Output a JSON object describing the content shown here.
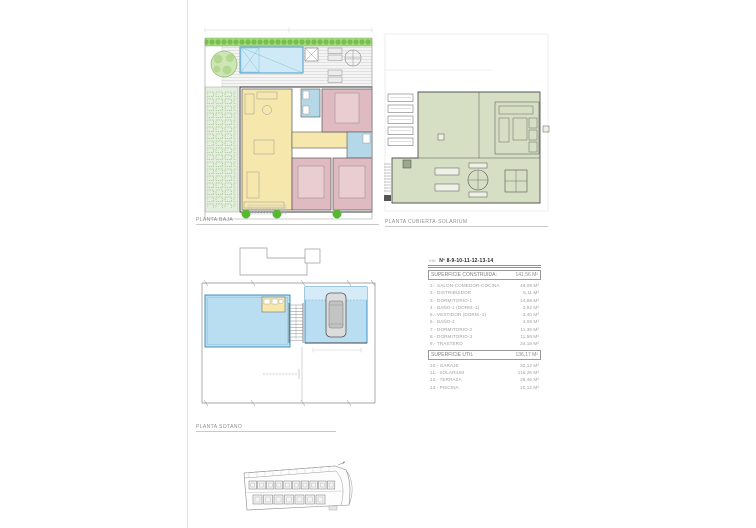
{
  "labels": {
    "planta_baja": "PLANTA BAJA",
    "planta_cubierta": "PLANTA CUBIERTA-SOLARIUM",
    "planta_sotano": "PLANTA SOTANO"
  },
  "table": {
    "viv_prefix": "VIV.",
    "title": "Nº 8-9-10-11-12-13-14",
    "construida": {
      "label": "SUPERFICIE CONSTRUIDA:",
      "value": "141,56 M²"
    },
    "rooms": [
      {
        "label": "1.- SALON-COMEDOR-COCINA",
        "value": "48,08 M²"
      },
      {
        "label": "2.- DISTRIBUIDOR",
        "value": "5,11 M²"
      },
      {
        "label": "3.- DORMITORIO-1",
        "value": "14,68 M²"
      },
      {
        "label": "4.- BAÑO-1 (DORM.-1)",
        "value": "3,92 M²"
      },
      {
        "label": "5.- VESTIDOR (DORM.-1)",
        "value": "3,40 M²"
      },
      {
        "label": "6.- BAÑO-2",
        "value": "4,09 M²"
      },
      {
        "label": "7.- DORMITORIO-2",
        "value": "11,36 M²"
      },
      {
        "label": "8.- DORMITORIO-3",
        "value": "11,56 M²"
      },
      {
        "label": "9.- TRASTERO",
        "value": "34,18 M²"
      }
    ],
    "util": {
      "label": "SUPERFICIE UTIL",
      "value": "136,17 M²"
    },
    "exterior": [
      {
        "label": "10.- GARAJE",
        "value": "32,12 M²"
      },
      {
        "label": "11.- SOLARIUM",
        "value": "116,26 M²"
      },
      {
        "label": "12.- TERRAZA",
        "value": "28,46 M²"
      },
      {
        "label": "13.- PISCINA",
        "value": "10,12 M²"
      }
    ]
  },
  "colors": {
    "pool_blue": "#cfeaf6",
    "basement_blue": "#badef1",
    "living_yellow": "#f6e7ad",
    "bedroom_pink": "#dfbac0",
    "bath_blue": "#b5d8e8",
    "solarium_green": "#d6dfc4",
    "garden_green": "#e3efdc",
    "hedge_green": "#8fd066"
  }
}
